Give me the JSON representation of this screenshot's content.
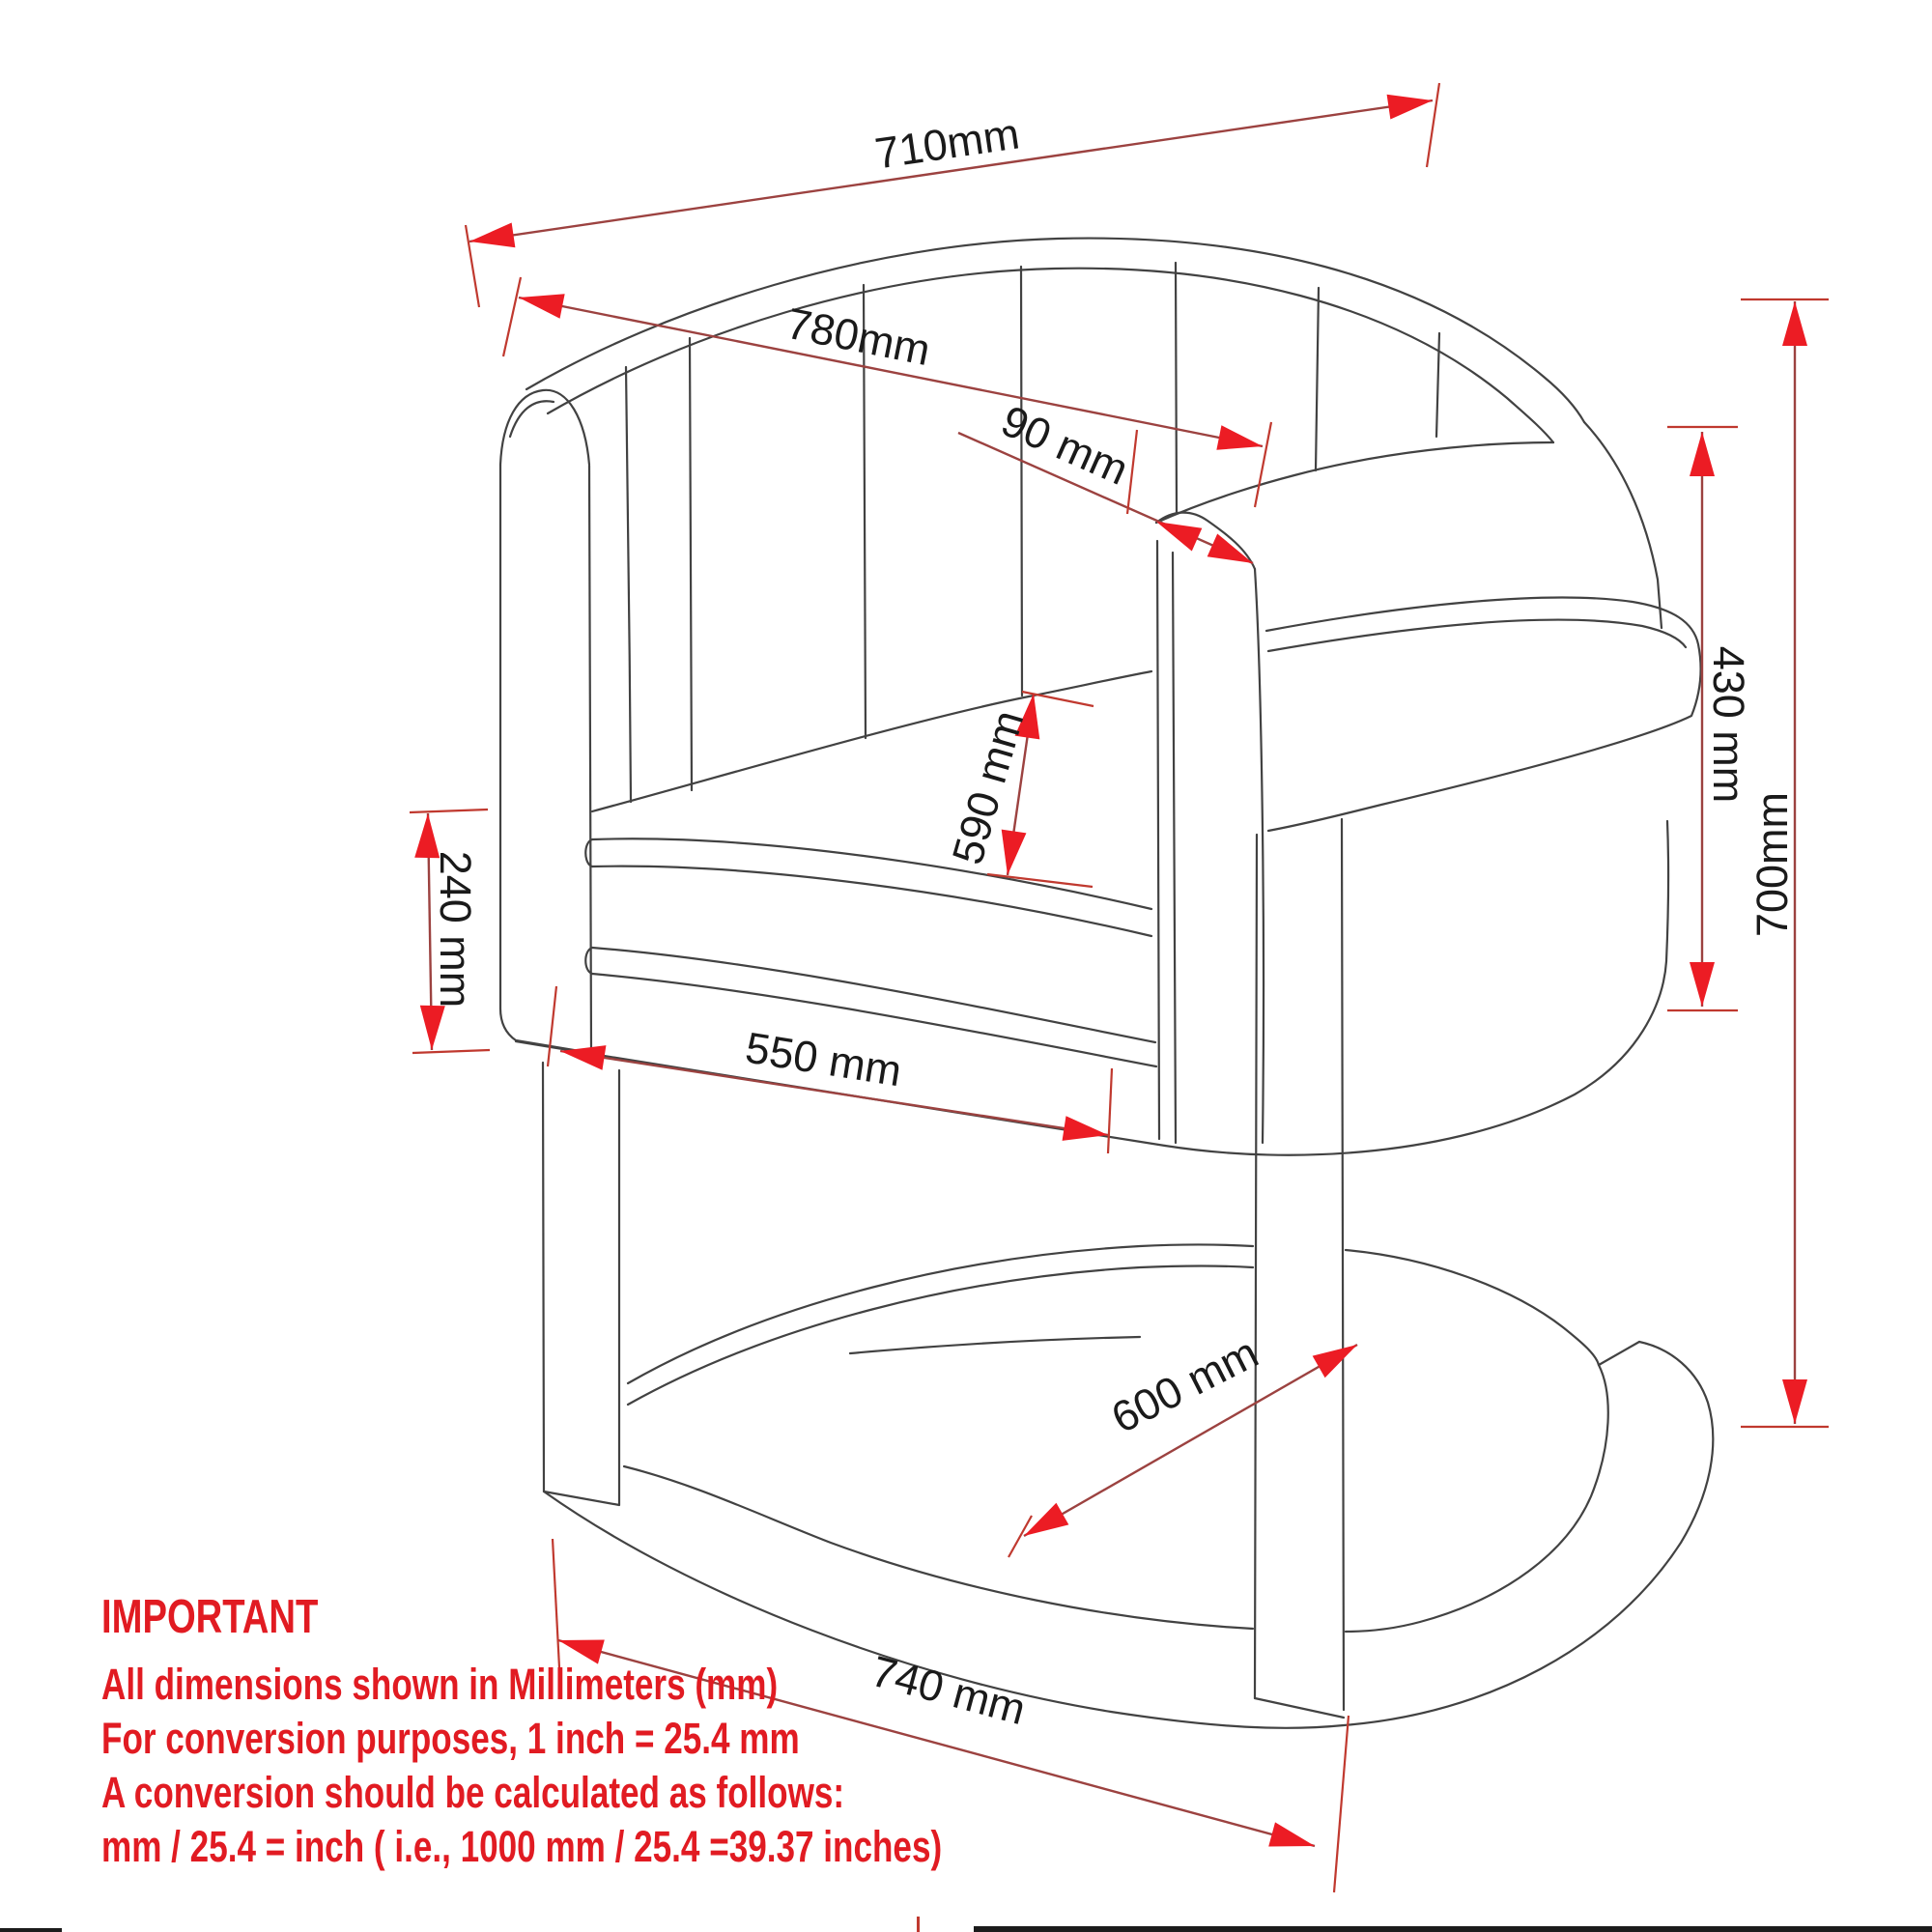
{
  "drawing": {
    "kind": "furniture technical dimension diagram",
    "subject": "barrel accent chair with cantilever base",
    "units": "mm"
  },
  "dims": {
    "d710": "710mm",
    "d780": "780mm",
    "d90": "90 mm",
    "d430": "430 mm",
    "d700": "700mm",
    "d590": "590 mm",
    "d240": "240 mm",
    "d550": "550 mm",
    "d600": "600 mm",
    "d740": "740 mm"
  },
  "dimensions_mm": {
    "overall_width": 710,
    "back_diagonal_width": 780,
    "arm_rail_thickness": 90,
    "seat_height": 430,
    "overall_height": 700,
    "seat_depth": 590,
    "arm_front_height": 240,
    "seat_width": 550,
    "base_depth": 600,
    "base_width": 740
  },
  "note": {
    "title": "IMPORTANT",
    "lines": [
      "All dimensions shown in Millimeters (mm)",
      "For conversion purposes, 1 inch = 25.4 mm",
      "A conversion should be calculated as follows:",
      "mm / 25.4 = inch ( i.e., 1000 mm / 25.4 =39.37 inches)"
    ]
  },
  "colors": {
    "background": "#ffffff",
    "drawing_line": "#424242",
    "dimension_line": "#9c4240",
    "extension_line": "#c0392f",
    "arrowhead": "#ec1c24",
    "dimension_text": "#1a1a1a",
    "note_text": "#e11b22",
    "bottom_bar": "#1b1b1b"
  }
}
